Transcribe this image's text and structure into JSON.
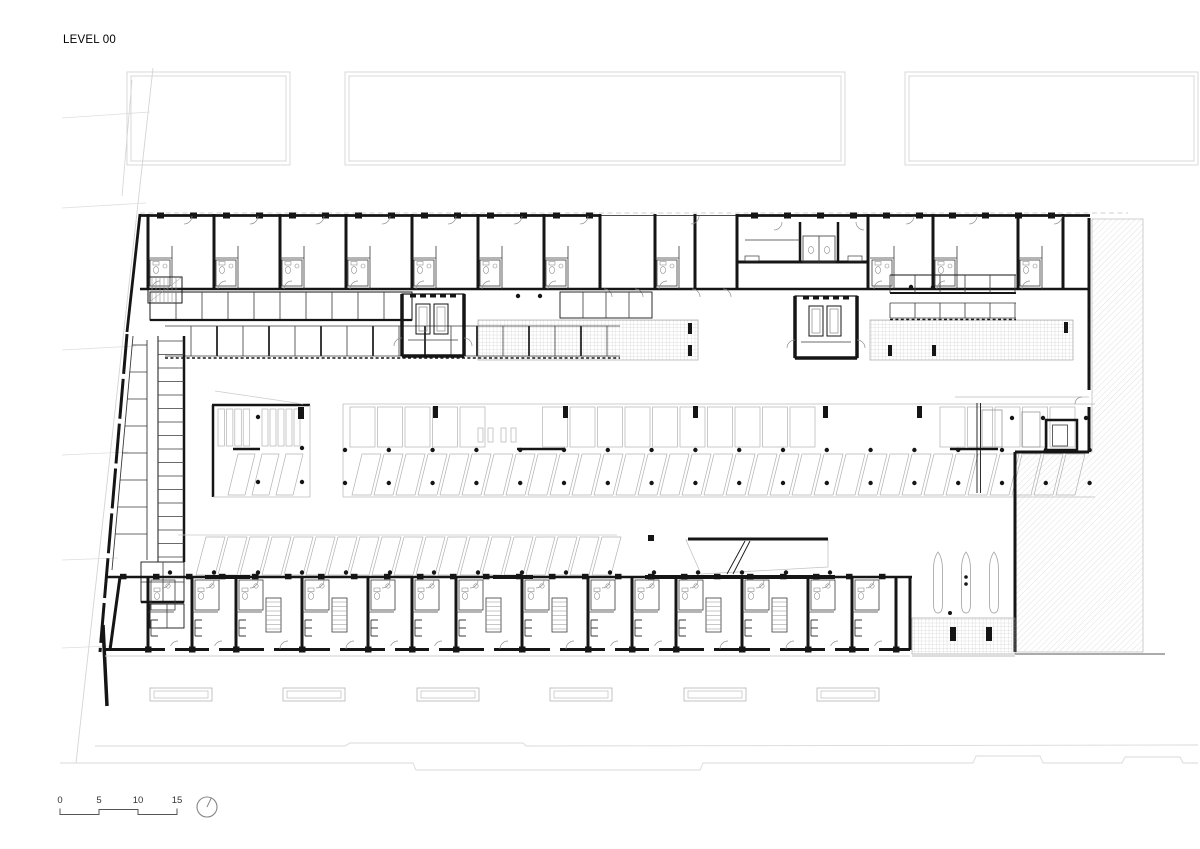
{
  "title": "LEVEL 00",
  "scale_bar": {
    "labels": [
      "0",
      "5",
      "10",
      "15"
    ]
  },
  "north_indicator": {
    "icon": "north-circle-icon"
  },
  "colors": {
    "ink": "#151515",
    "wall": "#1d1d1d",
    "thin": "#3a3a3a",
    "fixture": "#8f8f8f",
    "stall": "#b3b3b3",
    "context": "#d4d4d4",
    "context_dark": "#ababab",
    "hatch": "#c9c9c9",
    "grid": "#b4b4b4",
    "text": "#2a2a2a",
    "paper": "#ffffff"
  }
}
